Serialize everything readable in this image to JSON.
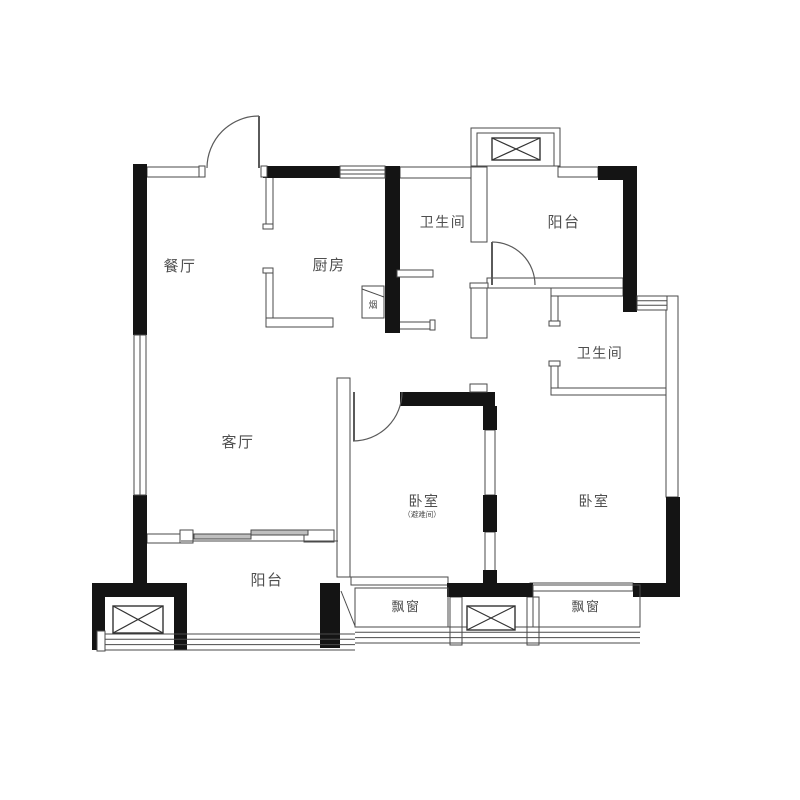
{
  "colors": {
    "wall": "#141414",
    "thin_line": "#4a4a4a",
    "text": "#4f4f4f",
    "background": "#ffffff"
  },
  "floorplan": {
    "rooms": [
      {
        "id": "dining",
        "label": "餐厅"
      },
      {
        "id": "kitchen",
        "label": "厨房"
      },
      {
        "id": "bathroom-top",
        "label": "卫生间"
      },
      {
        "id": "balcony-top",
        "label": "阳台"
      },
      {
        "id": "bathroom-right",
        "label": "卫生间"
      },
      {
        "id": "living",
        "label": "客厅"
      },
      {
        "id": "bedroom-middle",
        "label": "卧室",
        "sublabel": "（避难间）"
      },
      {
        "id": "bedroom-right",
        "label": "卧室"
      },
      {
        "id": "balcony-bottom",
        "label": "阳台"
      },
      {
        "id": "bay-window-left",
        "label": "飘窗"
      },
      {
        "id": "bay-window-right",
        "label": "飘窗"
      },
      {
        "id": "flue",
        "label": "烟"
      }
    ]
  }
}
